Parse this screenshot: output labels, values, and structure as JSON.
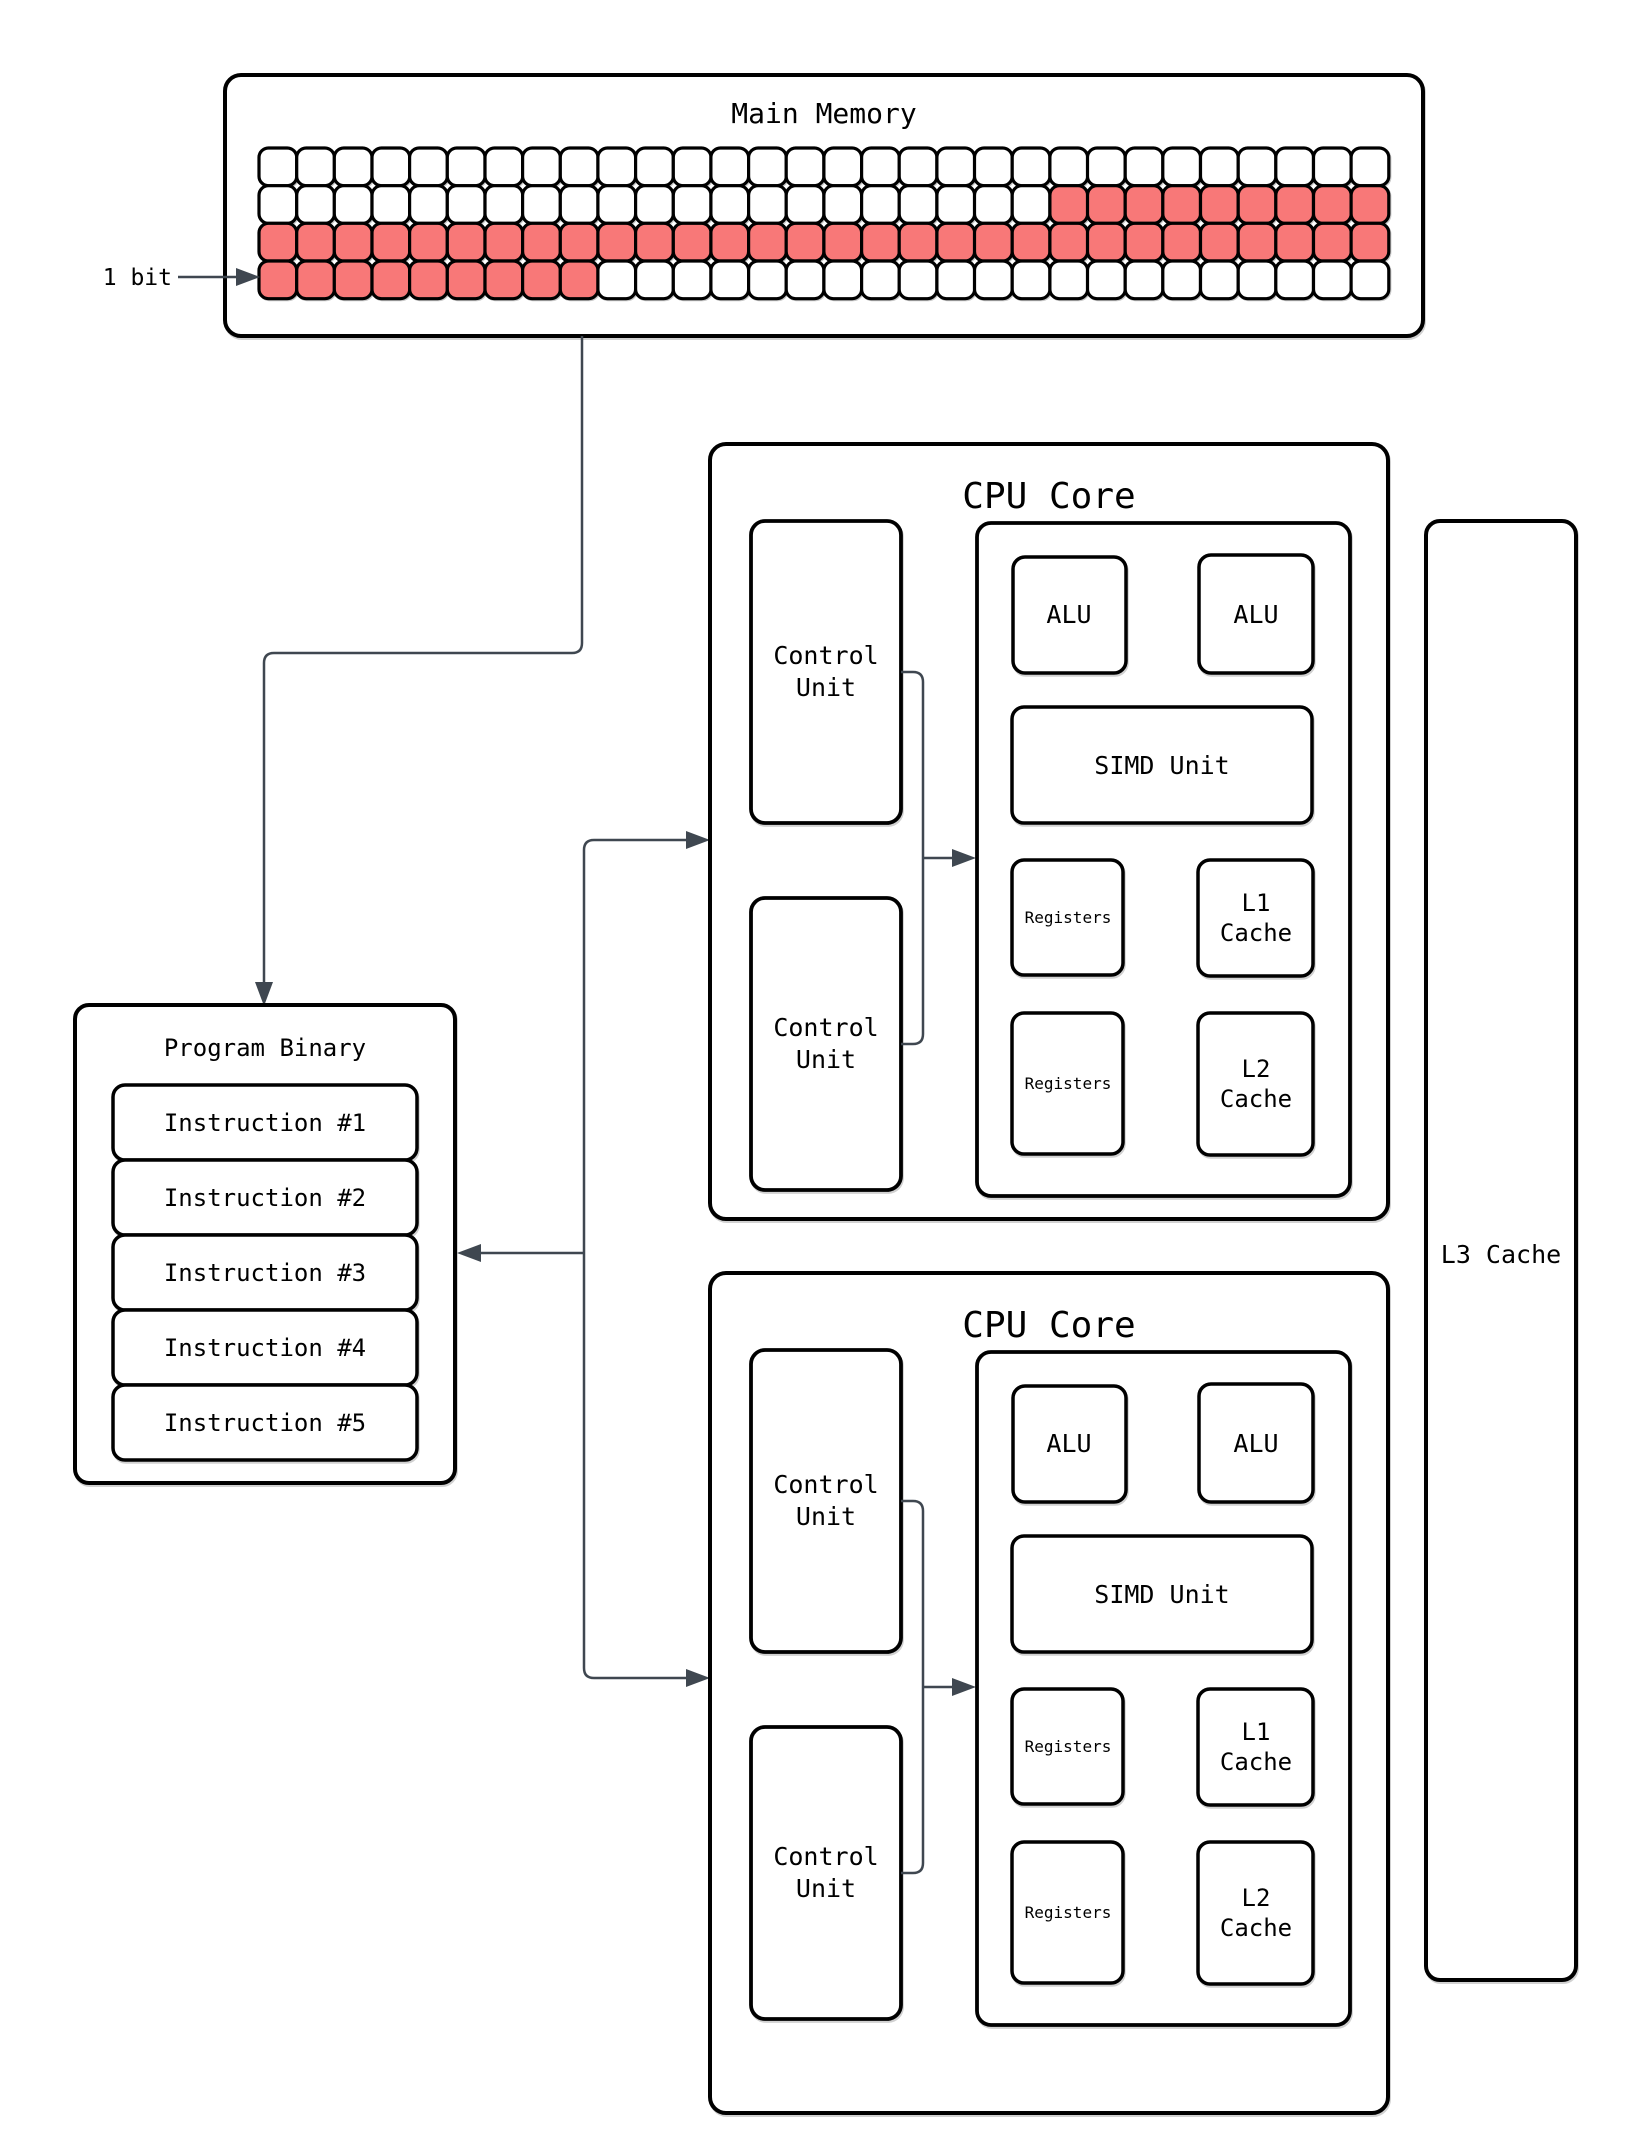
{
  "memory": {
    "title": "Main Memory",
    "bit_label": "1 bit",
    "grid": {
      "cols": 30,
      "rows": 4,
      "active_color": "#F87878",
      "inactive_color": "#FFFFFF",
      "active_cells": [
        {
          "row": 2,
          "from": 22,
          "to": 30
        },
        {
          "row": 3,
          "from": 1,
          "to": 30
        },
        {
          "row": 4,
          "from": 1,
          "to": 9
        }
      ]
    }
  },
  "program_binary": {
    "title": "Program Binary",
    "instructions": [
      "Instruction #1",
      "Instruction #2",
      "Instruction #3",
      "Instruction #4",
      "Instruction #5"
    ]
  },
  "cores": [
    {
      "title": "CPU Core"
    },
    {
      "title": "CPU Core"
    }
  ],
  "core_components": {
    "control_unit": [
      "Control",
      "Unit"
    ],
    "alu": "ALU",
    "simd": "SIMD Unit",
    "registers": "Registers",
    "l1_cache": [
      "L1",
      "Cache"
    ],
    "l2_cache": [
      "L2",
      "Cache"
    ]
  },
  "l3_cache": {
    "label": "L3 Cache"
  },
  "colors": {
    "accent_red": "#F87878",
    "connector": "#3F4750",
    "outline": "#000000"
  }
}
